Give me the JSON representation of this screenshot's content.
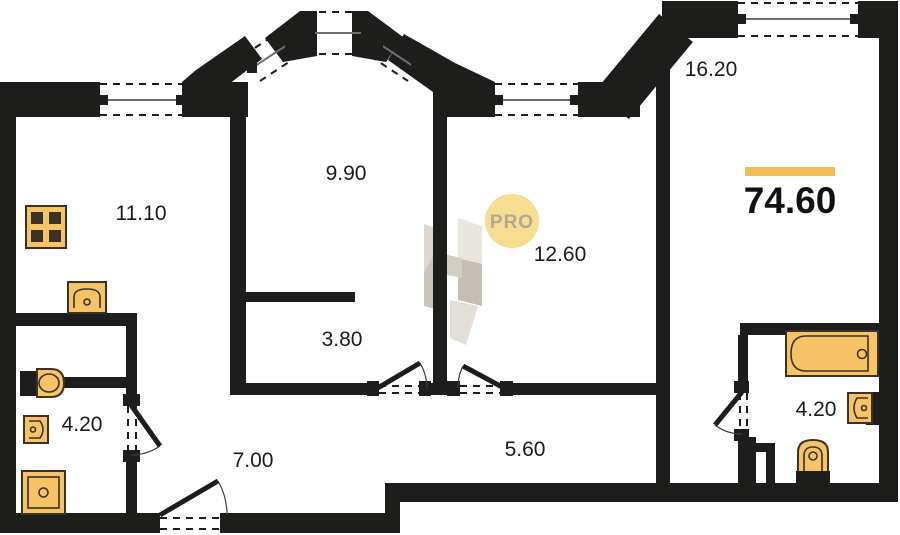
{
  "floorplan": {
    "total_area": "74.60",
    "rooms": [
      {
        "name": "kitchen",
        "area": "11.10"
      },
      {
        "name": "bedroom-bay",
        "area": "9.90"
      },
      {
        "name": "bedroom-middle",
        "area": "12.60"
      },
      {
        "name": "living-room",
        "area": "16.20"
      },
      {
        "name": "closet",
        "area": "3.80"
      },
      {
        "name": "bathroom-left",
        "area": "4.20"
      },
      {
        "name": "hallway",
        "area": "7.00"
      },
      {
        "name": "corridor",
        "area": "5.60"
      },
      {
        "name": "bathroom-right",
        "area": "4.20"
      }
    ],
    "fixtures": [
      "stove",
      "kitchen-sink",
      "toilet",
      "washbasin",
      "shower",
      "bathtub",
      "sink",
      "toilet"
    ],
    "watermark": {
      "badge": "PRO"
    },
    "colors": {
      "wall": "#1D1D1B",
      "fixture": "#F6C466",
      "fixture_dark": "#3A3226",
      "accent": "#F0BC55",
      "badge_fill": "#F7DD8F",
      "badge_text": "#B1A895",
      "logo_grey": "#D8D2CA"
    }
  }
}
